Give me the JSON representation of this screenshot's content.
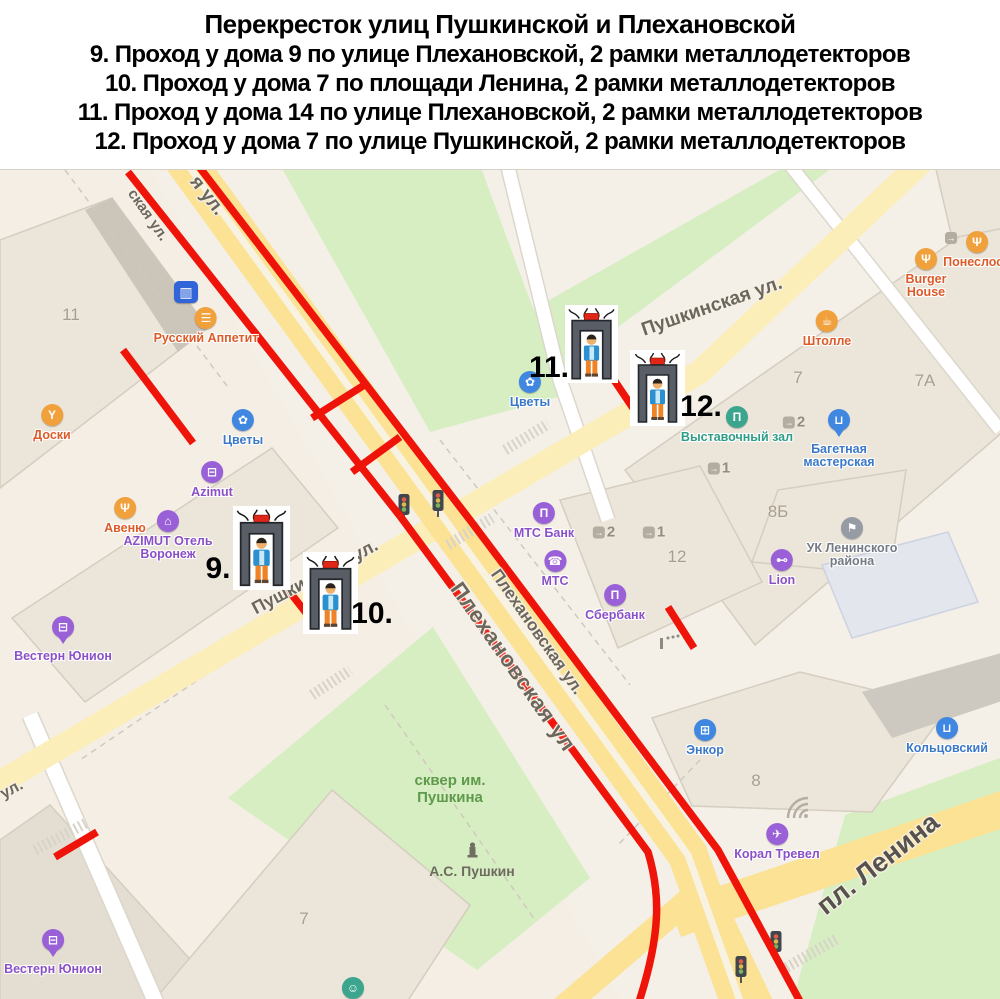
{
  "header": {
    "title": "Перекресток улиц Пушкинской и Плехановской",
    "lines": [
      "9. Проход у дома 9 по улице Плехановской, 2 рамки металлодетекторов",
      "10. Проход у дома 7 по площади Ленина, 2 рамки металлодетекторов",
      "11. Проход у дома 14 по улице Плехановской, 2 рамки металлодетекторов",
      "12. Проход у дома 7 по улице Пушкинской, 2 рамки металлодетекторов"
    ]
  },
  "map": {
    "streets": {
      "frag_left": "ская ул.",
      "frag_right": "я ул.",
      "pushkinskaya_ne": "Пушкинская ул.",
      "pushkinskaya_sw": "Пушкинская ул.",
      "plekhanovskaya_1": "Плехановская ул.",
      "plekhanovskaya_2": "Плехановская ул",
      "pl_lenina": "пл. Ленина",
      "ul_fragment": "ул.",
      "skver": "сквер им. Пушкина",
      "monument": "А.С. Пушкин"
    },
    "poi": {
      "russky_appetit": "Русский Аппетит",
      "doski": "Доски",
      "avenue": "Авеню",
      "burger_house": "Burger House",
      "poneslos": "Понеслось",
      "shtolle": "Штолле",
      "cvety1": "Цветы",
      "cvety2": "Цветы",
      "enkor": "Энкор",
      "kolcovsky": "Кольцовский",
      "bagetnaya": "Багетная мастерская",
      "azimut": "Azimut",
      "azimut_hotel": "AZIMUT Отель Воронеж",
      "western_union_1": "Вестерн Юнион",
      "western_union_2": "Вестерн Юнион",
      "mts_bank": "МТС Банк",
      "mts": "МТС",
      "sberbank": "Сбербанк",
      "lion": "Lion",
      "coral_travel": "Корал Тревел",
      "vystavochny_zal": "Выставочный зал",
      "uk_leninskogo": "УК Ленинского района"
    },
    "building_numbers": {
      "b11": "11",
      "b7ne": "7",
      "b7a": "7А",
      "b8b": "8Б",
      "b12": "12",
      "b8": "8",
      "b7sw": "7"
    },
    "entrances": {
      "e1": "2",
      "e2": "1",
      "e3": "2",
      "e4": "1"
    },
    "detectors": {
      "d9": "9.",
      "d10": "10.",
      "d11": "11.",
      "d12": "12."
    },
    "colors": {
      "red_line": "#ee1409",
      "road_yellow": "#fbe294",
      "road_pale": "#fceeb9",
      "green_area": "#d6eec2",
      "purple": "#9a60d8",
      "blue": "#3f87e0",
      "orange": "#f1a13c",
      "teal": "#3ba58e"
    }
  },
  "icons": {
    "burger": "☰",
    "food": "Ψ",
    "cafe": "☕",
    "bar": "Y",
    "flower": "✿",
    "case": "⊟",
    "hotel": "⌂",
    "bank": "Π",
    "phone": "☎",
    "gym": "⊷",
    "cart": "⊞",
    "bag": "⊔",
    "plane": "✈",
    "flag": "⚑",
    "mask": "☺",
    "tram": "▥",
    "entrance_arrow": "→"
  }
}
